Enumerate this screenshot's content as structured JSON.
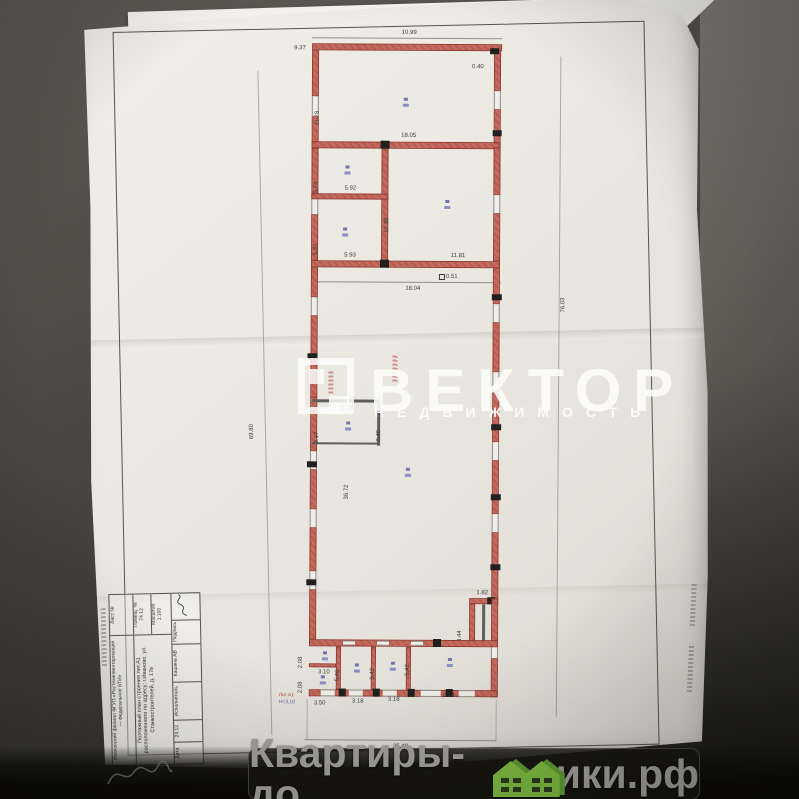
{
  "watermark": {
    "brand": "ВЕКТОР",
    "subtitle": "НЕДВИЖИМОСТЬ"
  },
  "footer": {
    "prefix": "Квартиры-до",
    "suffix": "ики.рф"
  },
  "plan": {
    "dims": {
      "offset_top_left": "9.37",
      "top_width": "10.99",
      "jog_top_right": "0.40",
      "room1_left_height": "11.78",
      "mid_wall_width": "18.05",
      "room2_upper_left": "3.74",
      "room2_width": "5.92",
      "core_height": "12.38",
      "room3_left_height": "5.37",
      "room3_width": "5.93",
      "mid_bottom_right": "11.81",
      "mid_bottom_total": "18.04",
      "mid_bottom_jog": "0.51",
      "closet_width": "2.78",
      "closet_right": "2.40",
      "closet_left": "2.17",
      "hall_length": "36.72",
      "left_overall": "69.80",
      "right_overall": "76.03",
      "notch_width": "1.82",
      "notch_height": "3.44",
      "cell_width_a": "3.10",
      "cell_height_a": "2.08",
      "cell_height_b": "2.08",
      "bottom_left_width": "3.50",
      "room5_height": "5.46",
      "room6_height": "5.42",
      "room7_height": "5.42",
      "bottom_room2_width": "3.18",
      "bottom_room3_width": "3.18",
      "bottom_room4_width": "6.14",
      "bottom_overall": "25.48"
    },
    "notes": {
      "liter": "Лит.А1",
      "height_note": "Н=3,10"
    }
  },
  "title_block": {
    "org": "Ивановский филиал ФГУП «Ростехинвентаризация — Федеральное БТИ»",
    "document": "Поэтажный план строения лит.А1 расположенного по адресу: г.Иваново, ул. Станкостроителей, д. 17в",
    "sheet_label": "Лист №",
    "room_label": "Помещ. №",
    "room_value": "74.12",
    "scale_label": "Масштаб",
    "scale_value": "1:100",
    "date_label": "Дата",
    "date_value": "24.12",
    "executor_label": "Исполнитель",
    "executor_value": "Кашина АВ",
    "signature_label": "Подпись"
  }
}
